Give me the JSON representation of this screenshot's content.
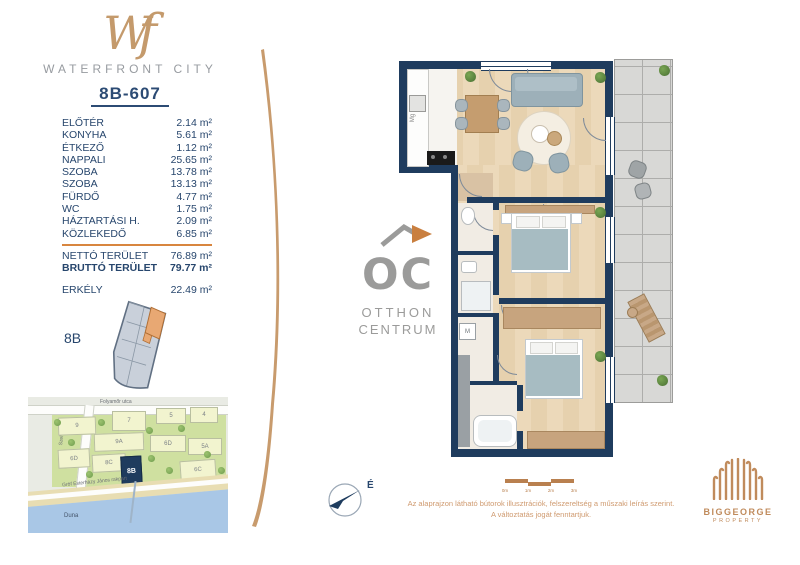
{
  "colors": {
    "navy": "#1f3c5e",
    "gold": "#c49a6c",
    "accent_orange": "#d8863f",
    "terrace_gray": "#d8d8d6"
  },
  "brand": {
    "logo": "Wf",
    "name": "WATERFRONT CITY"
  },
  "unit": {
    "code": "8B-607",
    "block_label": "8B"
  },
  "area_table": {
    "rows": [
      {
        "label": "ELŐTÉR",
        "value": "2.14 m²"
      },
      {
        "label": "KONYHA",
        "value": "5.61 m²"
      },
      {
        "label": "ÉTKEZŐ",
        "value": "1.12 m²"
      },
      {
        "label": "NAPPALI",
        "value": "25.65 m²"
      },
      {
        "label": "SZOBA",
        "value": "13.78 m²"
      },
      {
        "label": "SZOBA",
        "value": "13.13 m²"
      },
      {
        "label": "FÜRDŐ",
        "value": "4.77 m²"
      },
      {
        "label": "WC",
        "value": "1.75 m²"
      },
      {
        "label": "HÁZTARTÁSI H.",
        "value": "2.09 m²"
      },
      {
        "label": "KÖZLEKEDŐ",
        "value": "6.85 m²"
      }
    ],
    "net": {
      "label": "NETTÓ TERÜLET",
      "value": "76.89 m²"
    },
    "gross": {
      "label": "BRUTTÓ TERÜLET",
      "value": "79.77 m²"
    },
    "balcony": {
      "label": "ERKÉLY",
      "value": "22.49 m²"
    }
  },
  "map": {
    "street_top": "Folyamőr utca",
    "street_left": "Szellős utca",
    "embankment": "Gróf Esterházy János rakpart",
    "river": "Duna",
    "buildings": [
      "9",
      "7",
      "5",
      "4",
      "9A",
      "6D",
      "5A",
      "6D",
      "8C",
      "8B",
      "6C"
    ],
    "highlight": "8B"
  },
  "oc_logo": {
    "initials": "OC",
    "line1": "OTTHON",
    "line2": "CENTRUM"
  },
  "plan": {
    "fridge_label": "Mg",
    "washer_label": "M"
  },
  "compass": {
    "north_label": "É"
  },
  "scale_bar": {
    "ticks": [
      "0m",
      "1m",
      "2m",
      "3m"
    ]
  },
  "disclaimer": {
    "line1": "Az alaprajzon látható bútorok illusztrációk, felszereltség a műszaki leírás szerint.",
    "line2": "A változtatás jogát fenntartjuk."
  },
  "developer": {
    "name": "BIGGEORGE",
    "division": "PROPERTY"
  }
}
